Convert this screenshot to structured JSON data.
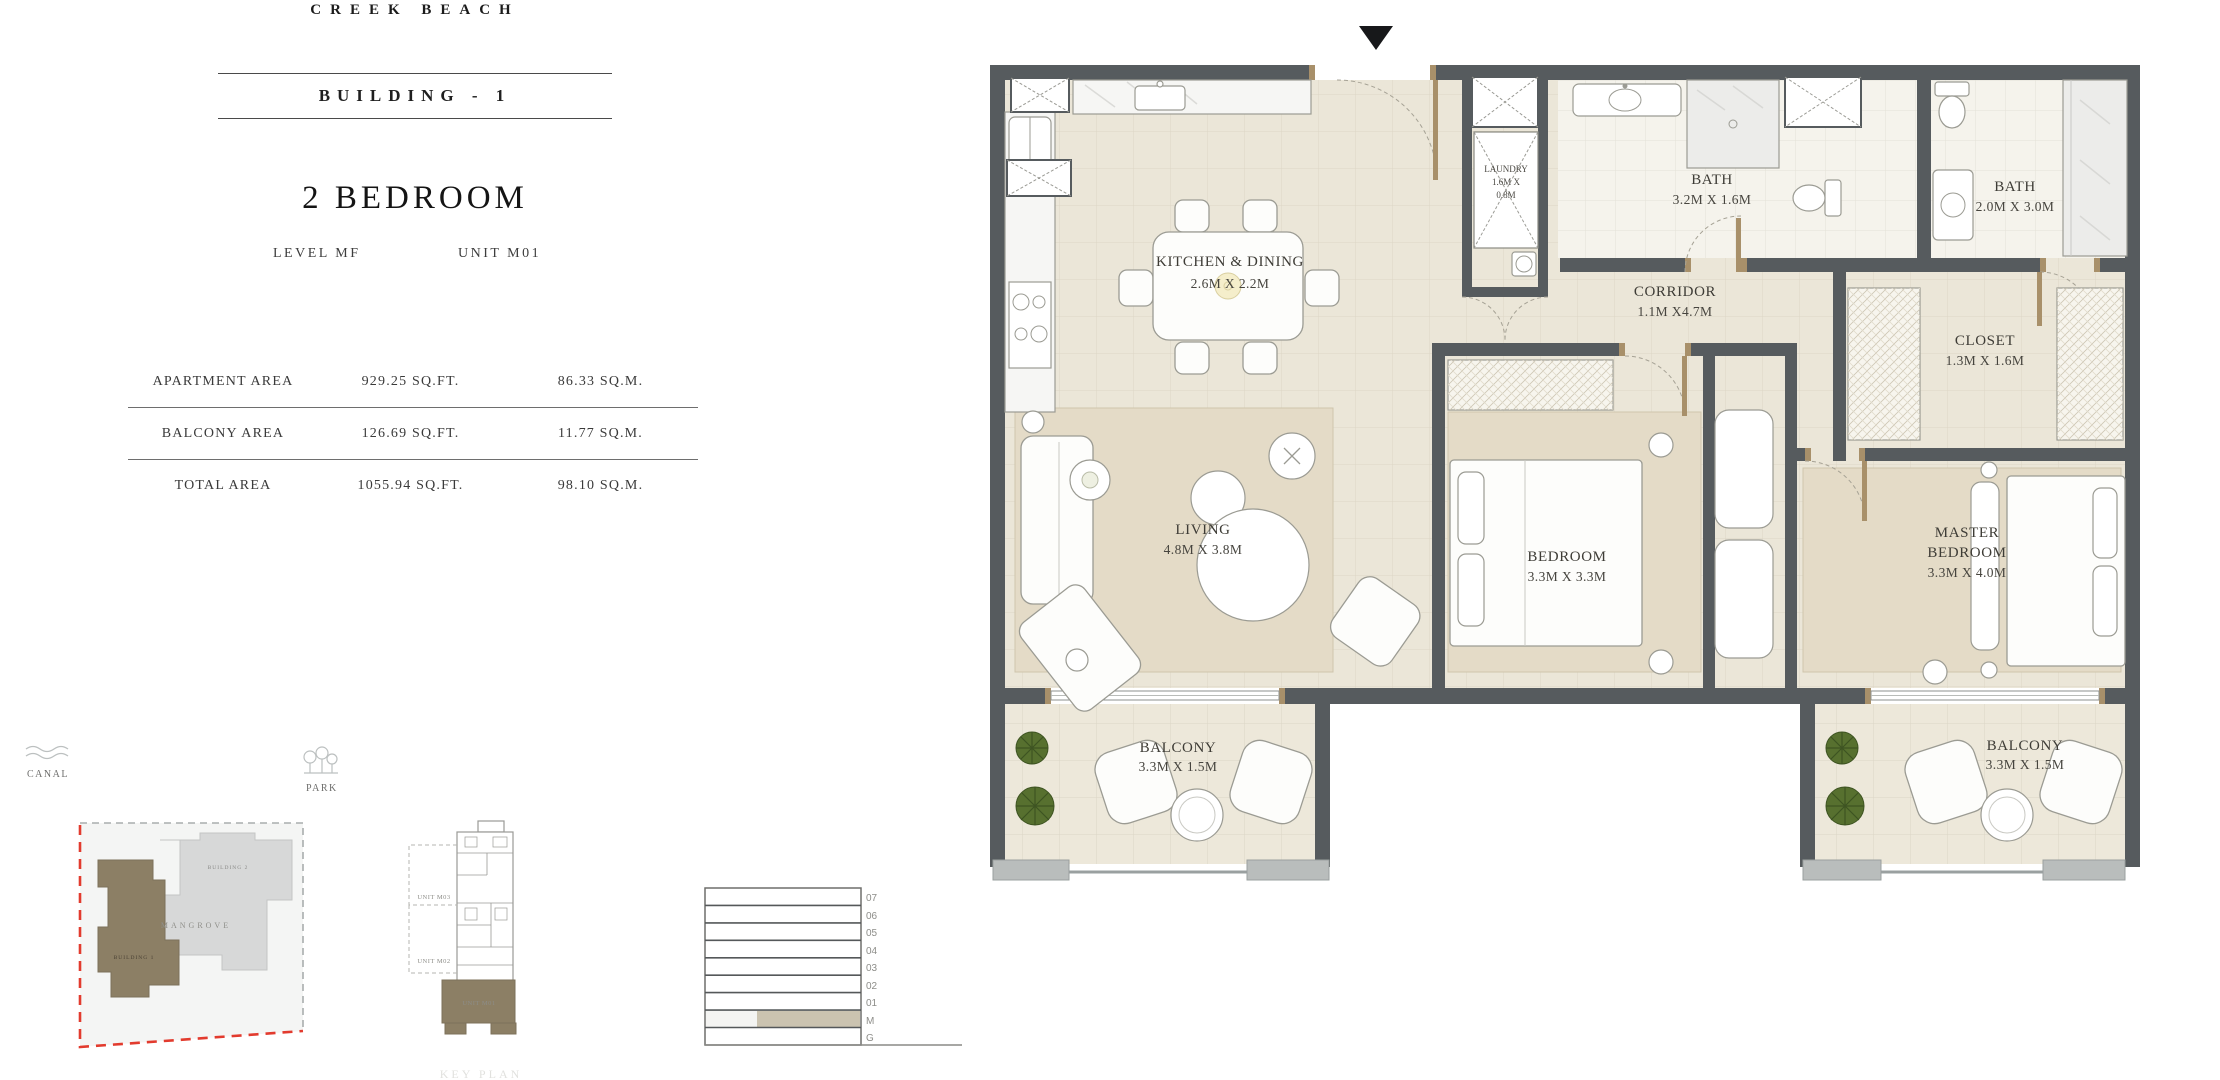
{
  "header": {
    "brand": "CREEK BEACH",
    "building": "BUILDING - 1",
    "unit_type": "2 BEDROOM",
    "level": "LEVEL MF",
    "unit": "UNIT M01"
  },
  "area_table": {
    "rows": [
      {
        "label": "APARTMENT AREA",
        "sqft": "929.25 SQ.FT.",
        "sqm": "86.33 SQ.M."
      },
      {
        "label": "BALCONY AREA",
        "sqft": "126.69 SQ.FT.",
        "sqm": "11.77 SQ.M."
      },
      {
        "label": "TOTAL AREA",
        "sqft": "1055.94 SQ.FT.",
        "sqm": "98.10 SQ.M."
      }
    ]
  },
  "floor_plan": {
    "rooms": [
      {
        "id": "kitchen-dining",
        "lines": [
          "KITCHEN & DINING",
          "2.6M X 2.2M"
        ]
      },
      {
        "id": "laundry",
        "lines": [
          "LAUNDRY",
          "1.6M X",
          "0.8M"
        ]
      },
      {
        "id": "bath-1",
        "lines": [
          "BATH",
          "3.2M X 1.6M"
        ]
      },
      {
        "id": "bath-2",
        "lines": [
          "BATH",
          "2.0M X 3.0M"
        ]
      },
      {
        "id": "corridor",
        "lines": [
          "CORRIDOR",
          "1.1M X4.7M"
        ]
      },
      {
        "id": "closet",
        "lines": [
          "CLOSET",
          "1.3M X 1.6M"
        ]
      },
      {
        "id": "living",
        "lines": [
          "LIVING",
          "4.8M X 3.8M"
        ]
      },
      {
        "id": "bedroom",
        "lines": [
          "BEDROOM",
          "3.3M X 3.3M"
        ]
      },
      {
        "id": "master-bedroom",
        "lines": [
          "MASTER",
          "BEDROOM",
          "3.3M X 4.0M"
        ]
      },
      {
        "id": "balcony-left",
        "lines": [
          "BALCONY",
          "3.3M X 1.5M"
        ]
      },
      {
        "id": "balcony-right",
        "lines": [
          "BALCONY",
          "3.3M X 1.5M"
        ]
      }
    ]
  },
  "site_plan": {
    "canal": "CANAL",
    "park": "PARK",
    "mangrove": "MANGROVE",
    "building_1": "BUILDING 1",
    "building_2": "BUILDING 2"
  },
  "key_plan": {
    "unit_m03": "UNIT M03",
    "unit_m02": "UNIT M02",
    "unit_m01": "UNIT M01",
    "caption": "KEY PLAN"
  },
  "level_diagram": {
    "floors": [
      "07",
      "06",
      "05",
      "04",
      "03",
      "02",
      "01",
      "M",
      "G"
    ],
    "highlighted_floor": "M"
  },
  "colors": {
    "wall": "#565b5e",
    "floor": "#ebe6d8",
    "carpet": "#e4dbc7",
    "wood": "#a8906a",
    "accent_taupe": "#8c7f65",
    "site_red": "#e23b2e",
    "plant_green": "#57702f"
  }
}
